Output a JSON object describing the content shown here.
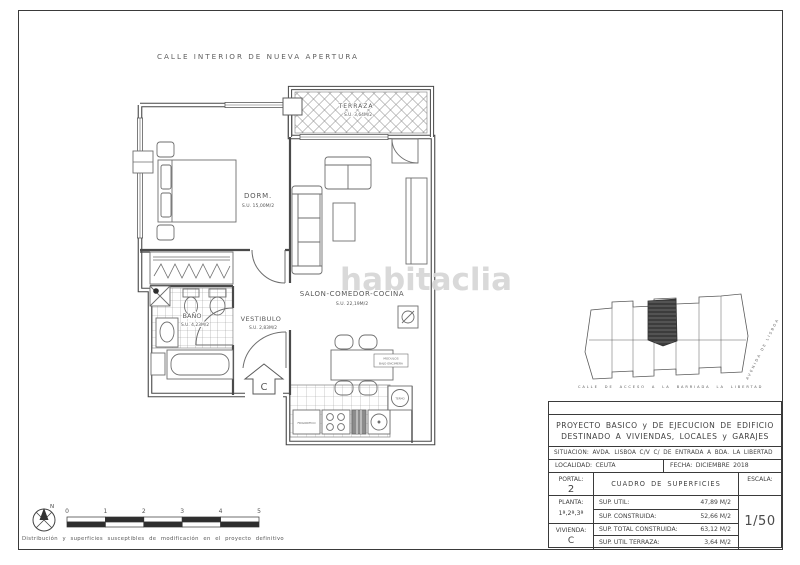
{
  "header": {
    "street_top": "CALLE INTERIOR DE NUEVA APERTURA"
  },
  "watermark": {
    "text": "habitaclia"
  },
  "plan": {
    "rooms": [
      {
        "id": "terraza",
        "name": "TERRAZA",
        "area": "S.U. 3,64M/2"
      },
      {
        "id": "dormitorio",
        "name": "DORM.",
        "area": "S.U. 15,00M/2"
      },
      {
        "id": "salon",
        "name": "SALON-COMEDOR-COCINA",
        "area": "S.U. 22,19M/2"
      },
      {
        "id": "bano",
        "name": "BAÑO",
        "area": "S.U. 4,23M/2"
      },
      {
        "id": "vestibulo",
        "name": "VESTIBULO",
        "area": "S.U. 2,83M/2"
      }
    ],
    "entrance_letter": "C",
    "notes": {
      "fridge": "FRIGORIFICO",
      "under_counter_1": "MODULOS",
      "under_counter_2": "BAJO ENCIMERA",
      "water_heater": "TERMO"
    }
  },
  "site_plan": {
    "street_bottom": "CALLE DE ACCESO A LA BARRIADA LA LIBERTAD",
    "street_right": "AVENIDA DE LISBOA"
  },
  "scale_bar": {
    "north": "N",
    "ticks": [
      "0",
      "1",
      "2",
      "3",
      "4",
      "5"
    ]
  },
  "title_block": {
    "project_title_line1": "PROYECTO BASICO y DE EJECUCION DE EDIFICIO",
    "project_title_line2": "DESTINADO A VIVIENDAS, LOCALES y GARAJES",
    "situacion": "SITUACION: AVDA. LISBOA C/V C/ DE ENTRADA A BDA. LA LIBERTAD",
    "localidad": "LOCALIDAD: CEUTA",
    "fecha": "FECHA: DICIEMBRE 2018",
    "portal_label": "PORTAL:",
    "portal_value": "2",
    "cuadro_title": "CUADRO DE SUPERFICIES",
    "escala_label": "ESCALA:",
    "escala_value": "1/50",
    "planta_label": "PLANTA:",
    "planta_value": "1ª,2ª,3ª",
    "vivienda_label": "VIVIENDA:",
    "vivienda_value": "C",
    "rows": [
      {
        "label": "SUP. UTIL:",
        "value": "47,89 M/2"
      },
      {
        "label": "SUP. CONSTRUIDA:",
        "value": "52,66 M/2"
      },
      {
        "label": "SUP. TOTAL CONSTRUIDA:",
        "value": "63,12 M/2"
      },
      {
        "label": "SUP. UTIL TERRAZA:",
        "value": "3,64 M/2"
      }
    ]
  },
  "footer": {
    "note": "Distribución y superficies susceptibles de modificación en el proyecto definitivo"
  }
}
